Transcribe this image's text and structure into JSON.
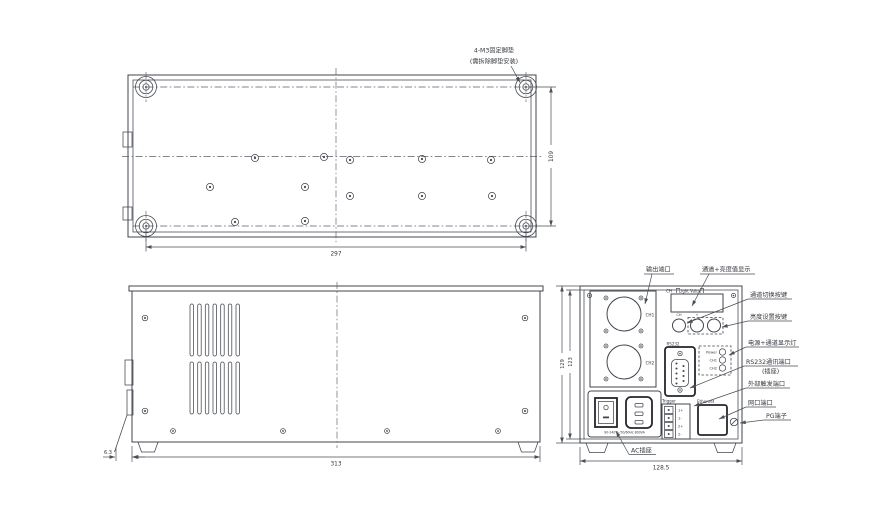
{
  "top_view": {
    "note_line1": "4-M3固定脚垫",
    "note_line2": "(需拆除脚垫安装)",
    "dim_width": "297",
    "dim_height": "109"
  },
  "side_view": {
    "dim_length": "313",
    "dim_offset": "6.3"
  },
  "rear_view": {
    "dim_width": "128.5",
    "dim_height_outer": "129",
    "dim_height_inner": "123",
    "panel": {
      "ch1": "CH1",
      "ch2": "CH2",
      "display_ch_label": "CH",
      "display_value_label": "Light Value",
      "btn_channel": "CH",
      "btn_plus": "+",
      "btn_minus": "-",
      "rs232": "RS232",
      "led_power": "Power",
      "led_ch1": "CH1",
      "led_ch2": "CH2",
      "trigger": "Trigger",
      "pin1": "1+",
      "pin2": "1-",
      "pin3": "2+",
      "pin4": "2-",
      "ethernet": "Ethernet",
      "ac_rating": "90-240V~50/60Hz 800VA"
    },
    "annotations": {
      "output_port": "输出端口",
      "display": "通道+亮度值显示",
      "channel_switch": "通道切换按键",
      "brightness_set": "亮度设置按键",
      "power_leds": "电源+通道显示灯",
      "rs232_port": "RS232通讯端口",
      "rs232_socket": "(插座)",
      "ext_trigger": "外部触发端口",
      "lan_port": "网口端口",
      "pg_terminal": "PG端子",
      "ac_socket": "AC插座"
    }
  }
}
